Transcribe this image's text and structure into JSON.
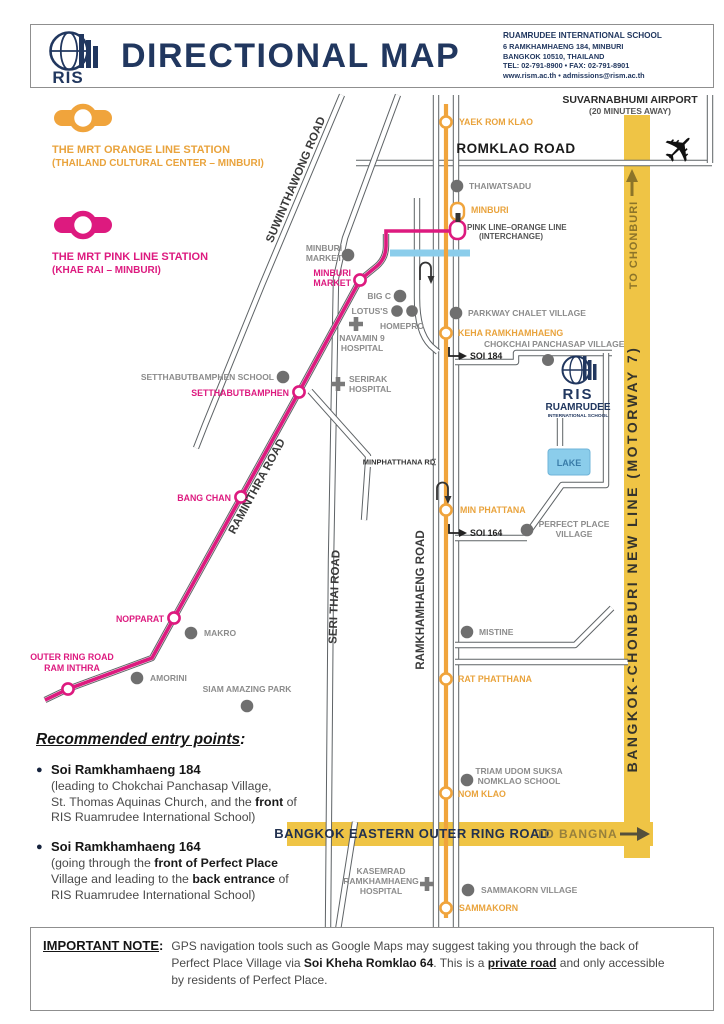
{
  "colors": {
    "orange": "#F0A43C",
    "pink": "#DD1A7F",
    "yellow": "#EFC445",
    "navy": "#21375F",
    "road_gray": "#5E6366",
    "canal_blue": "#8BCDEB"
  },
  "header": {
    "logo_abbr": "RIS",
    "title": "DIRECTIONAL MAP",
    "school": {
      "name": "RUAMRUDEE INTERNATIONAL SCHOOL",
      "address1": "6 RAMKHAMHAENG 184, MINBURI",
      "address2": "BANGKOK 10510, THAILAND",
      "phone": "TEL: 02-791-8900 • FAX: 02-791-8901",
      "web": "www.rism.ac.th • admissions@rism.ac.th"
    }
  },
  "legend": {
    "orange_title": "THE MRT ORANGE LINE STATION",
    "orange_subtitle": "(THAILAND CULTURAL CENTER – MINBURI)",
    "pink_title": "THE MRT PINK LINE STATION",
    "pink_subtitle": "(KHAE RAI – MINBURI)"
  },
  "map": {
    "airport_name": "SUVARNABHUMI AIRPORT",
    "airport_note": "(20 MINUTES AWAY)",
    "roads": {
      "romklao": "ROMKLAO ROAD",
      "suwinthawong": "SUWINTHAWONG ROAD",
      "raminthra": "RAMINTHRA ROAD",
      "seri_thai": "SERI THAI ROAD",
      "ramkhamhaeng": "RAMKHAMHAENG ROAD",
      "minphatthana": "MINPHATTHANA RD",
      "soi_184": "SOI 184",
      "soi_164": "SOI 164",
      "to_chonburi": "TO CHONBURI",
      "motorway": "BANGKOK-CHONBURI NEW LINE  (MOTORWAY 7)",
      "outer_ring": "BANGKOK EASTERN OUTER RING ROAD",
      "to_bangna": "TO BANGNA"
    },
    "stations_orange": {
      "yaek_rom_klao": "YAEK ROM KLAO",
      "minburi": "MINBURI",
      "keha_ramkhamhaeng": "KEHA RAMKHAMHAENG",
      "min_phattana": "MIN PHATTANA",
      "rat_phatthana": "RAT PHATTHANA",
      "nom_klao": "NOM KLAO",
      "sammakorn": "SAMMAKORN"
    },
    "interchange_line1": "PINK LINE–ORANGE LINE",
    "interchange_line2": "(INTERCHANGE)",
    "stations_pink": {
      "minburi_market_l1": "MINBURI",
      "minburi_market_l2": "MARKET",
      "setthabutbamphen": "SETTHABUTBAMPHEN",
      "bang_chan": "BANG CHAN",
      "nopparat": "NOPPARAT",
      "outer_ring_l1": "OUTER RING ROAD",
      "outer_ring_l2": "RAM INTHRA"
    },
    "landmarks": {
      "thaiwatsadu": "THAIWATSADU",
      "minburi_market_l1": "MINBURI",
      "minburi_market_l2": "MARKET",
      "big_c": "BIG C",
      "lotus": "LOTUS'S",
      "homepro": "HOMEPRO",
      "navamin_l1": "NAVAMIN 9",
      "navamin_l2": "HOSPITAL",
      "serirak_l1": "SERIRAK",
      "serirak_l2": "HOSPITAL",
      "setthabut_school": "SETTHABUTBAMPHEN SCHOOL",
      "parkway": "PARKWAY CHALET VILLAGE",
      "chokchai": "CHOKCHAI PANCHASAP VILLAGE",
      "perfect_l1": "PERFECT PLACE",
      "perfect_l2": "VILLAGE",
      "lake": "LAKE",
      "mistine": "MISTINE",
      "makro": "MAKRO",
      "amorini": "AMORINI",
      "siam_park": "SIAM AMAZING PARK",
      "triam_l1": "TRIAM UDOM SUKSA",
      "triam_l2": "NOMKLAO SCHOOL",
      "kasemrad_l1": "KASEMRAD",
      "kasemrad_l2": "RAMKHAMHAENG",
      "kasemrad_l3": "HOSPITAL",
      "sammakorn_village": "SAMMAKORN VILLAGE"
    },
    "ris_logo": {
      "abbr": "RIS",
      "name": "RUAMRUDEE",
      "sub": "INTERNATIONAL SCHOOL"
    }
  },
  "entry": {
    "heading": "Recommended entry points",
    "colon": ":",
    "p1": {
      "title": "Soi Ramkhamhaeng 184",
      "l1": "(leading to Chokchai Panchasap Village,",
      "l2a": "St. Thomas Aquinas Church, and the ",
      "l2b": "front",
      "l2c": " of",
      "l3": "RIS Ruamrudee International School)"
    },
    "p2": {
      "title": "Soi Ramkhamhaeng 164",
      "l1a": "(going through the ",
      "l1b": "front of Perfect Place",
      "l2a": "Village and leading to the ",
      "l2b": "back entrance",
      "l2c": " of",
      "l3": "RIS Ruamrudee International School)"
    }
  },
  "note": {
    "label": "IMPORTANT NOTE",
    "colon": ":",
    "l1": "GPS navigation tools such as Google Maps may suggest taking you through the back of",
    "l2a": "Perfect Place Village via ",
    "l2b": "Soi Kheha Romklao 64",
    "l2c": ". This is a ",
    "l2d": "private road",
    "l2e": " and only accessible",
    "l3": "by residents of Perfect Place."
  }
}
